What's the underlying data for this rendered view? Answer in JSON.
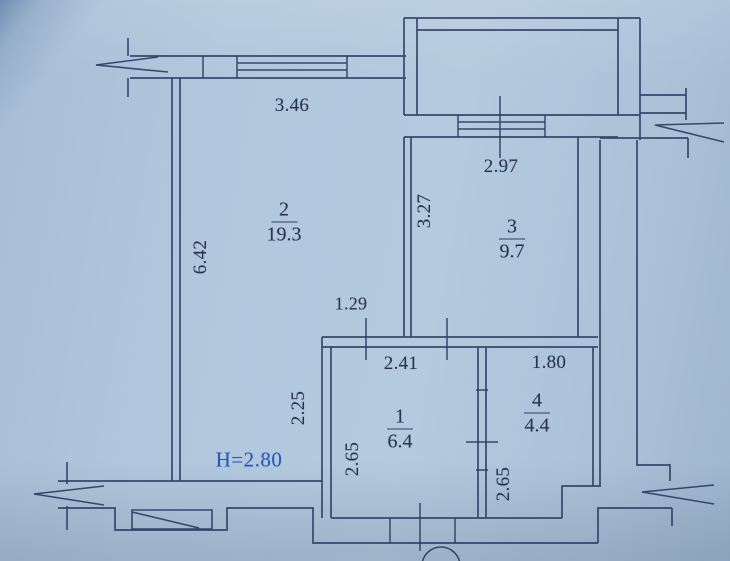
{
  "plan": {
    "height_label": "H=2.80",
    "rooms": [
      {
        "name": "room-2",
        "number": "2",
        "area": "19.3"
      },
      {
        "name": "room-3",
        "number": "3",
        "area": "9.7"
      },
      {
        "name": "room-1",
        "number": "1",
        "area": "6.4"
      },
      {
        "name": "room-4",
        "number": "4",
        "area": "4.4"
      }
    ],
    "dims": {
      "d346": "3.46",
      "d297": "2.97",
      "d642": "6.42",
      "d327": "3.27",
      "d129": "1.29",
      "d241": "2.41",
      "d180": "1.80",
      "d225": "2.25",
      "d265a": "2.65",
      "d265b": "2.65"
    },
    "colors": {
      "paper": "#afc5db",
      "ink": "#2e3e63",
      "accent_blue": "#2857bf"
    }
  }
}
